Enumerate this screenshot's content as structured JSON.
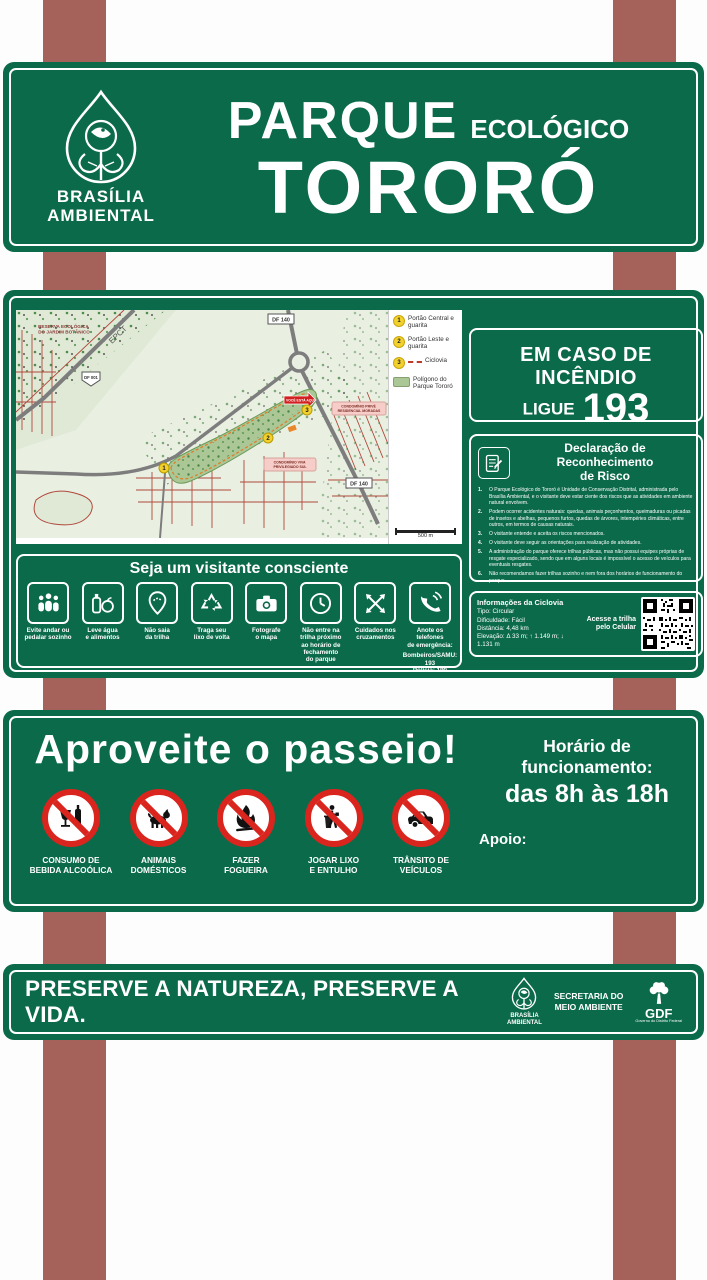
{
  "colors": {
    "panel_green": "#0b6a4a",
    "post_brown": "#a5625a",
    "prohibition_red": "#d9251d",
    "marker_yellow": "#f2d02e",
    "map_land": "#e9f0e2",
    "park_polygon": "#aac795",
    "street_red": "#b0483a"
  },
  "header": {
    "brand_line1": "BRASÍLIA",
    "brand_line2": "AMBIENTAL",
    "title_main": "PARQUE",
    "title_sub": "ECOLÓGICO",
    "park_name": "TORORÓ"
  },
  "map": {
    "labels": {
      "reserve_l1": "RESERVA ECOLÓGICA",
      "reserve_l2": "DO JARDIM BOTÂNICO",
      "epct": "EPCT",
      "shield": "DF 001",
      "df140_top": "DF 140",
      "df140_right": "DF 140",
      "condo_right_l1": "CONDOMÍNIO PRIVÊ",
      "condo_right_l2": "RESIDENCIAL MORADAS",
      "condo_mid_l1": "CONDOMÍNIO VIVA",
      "condo_mid_l2": "PRIVILEGIADO SUL",
      "you_are_here": "VOCÊ ESTÁ AQUI"
    },
    "markers": {
      "m1": "1",
      "m2": "2",
      "m3": "3"
    },
    "legend": {
      "item1": {
        "num": "1",
        "label": "Portão Central e guarita"
      },
      "item2": {
        "num": "2",
        "label": "Portão Leste e guarita"
      },
      "item3": {
        "num": "3",
        "label": "Ciclovia"
      },
      "item4": {
        "label": "Polígono do Parque Tororó"
      }
    },
    "scale": "500 m"
  },
  "emergency": {
    "line1": "EM CASO DE INCÊNDIO",
    "call_prefix": "LIGUE",
    "number": "193"
  },
  "declaration": {
    "title": "Declaração de Reconhecimento\nde Risco",
    "items": [
      {
        "n": "1.",
        "t": "O Parque Ecológico do Tororó é Unidade de Conservação Distrital, administrada pelo Brasília Ambiental, e o visitante deve estar ciente dos riscos que as atividades em ambiente natural envolvem."
      },
      {
        "n": "2.",
        "t": "Podem ocorrer acidentes naturais: quedas, animais peçonhentos, queimaduras ou picadas de insetos e abelhas, pequenos furtos, quedas de árvores, intempéries climáticas, entre outros, em termos de causas naturais."
      },
      {
        "n": "3.",
        "t": "O visitante entende e aceita os riscos mencionados."
      },
      {
        "n": "4.",
        "t": "O visitante deve seguir as orientações para realização de atividades."
      },
      {
        "n": "5.",
        "t": "A administração do parque oferece trilhas públicas, mas não possui equipes próprias de resgate especializado, sendo que em alguns locais é impossível o acesso de veículos para eventuais resgates."
      },
      {
        "n": "6.",
        "t": "Não recomendamos fazer trilhas sozinho e nem fora dos horários de funcionamento do parque."
      }
    ]
  },
  "visitor": {
    "title": "Seja um visitante consciente",
    "tips": [
      {
        "icon": "group-icon",
        "label": "Evite andar ou\npedalar sozinho"
      },
      {
        "icon": "water-food-icon",
        "label": "Leve água\ne alimentos"
      },
      {
        "icon": "stay-on-trail-icon",
        "label": "Não saia\nda trilha"
      },
      {
        "icon": "recycle-icon",
        "label": "Traga seu\nlixo de volta"
      },
      {
        "icon": "camera-icon",
        "label": "Fotografe\no mapa"
      },
      {
        "icon": "clock-icon",
        "label": "Não entre na\ntrilha próximo\nao horário de\nfechamento\ndo parque"
      },
      {
        "icon": "crossings-icon",
        "label": "Cuidados nos\ncruzamentos"
      },
      {
        "icon": "phone-icon",
        "label": "Anote os telefones\nde emergência:"
      }
    ],
    "emergency_line1": "Bombeiros/SAMU: 193",
    "emergency_line2": "Polícia: 190"
  },
  "ciclovia": {
    "title": "Informações da Ciclovia",
    "line_tipo": "Tipo: Circular",
    "line_dificuldade": "Dificuldade: Fácil",
    "line_distancia": "Distância: 4,48 km",
    "line_elevacao": "Elevação: Δ 33 m; ↑ 1.149 m; ↓ 1.131 m",
    "qr_caption": "Acesse a trilha\npelo Celular"
  },
  "enjoy": {
    "title": "Aproveite o passeio!",
    "hours_label": "Horário de funcionamento:",
    "hours_value": "das 8h às 18h",
    "support_label": "Apoio:",
    "prohibitions": [
      {
        "icon": "no-alcohol-icon",
        "label": "CONSUMO DE\nBEBIDA ALCOÓLICA"
      },
      {
        "icon": "no-pets-icon",
        "label": "ANIMAIS\nDOMÉSTICOS"
      },
      {
        "icon": "no-fire-icon",
        "label": "FAZER\nFOGUEIRA"
      },
      {
        "icon": "no-litter-icon",
        "label": "JOGAR LIXO\nE ENTULHO"
      },
      {
        "icon": "no-vehicles-icon",
        "label": "TRÂNSITO DE\nVEÍCULOS"
      }
    ]
  },
  "footer": {
    "message": "PRESERVE A NATUREZA, PRESERVE A VIDA.",
    "brand1": "BRASÍLIA\nAMBIENTAL",
    "brand2": "SECRETARIA DO\nMEIO AMBIENTE",
    "brand3": "GDF",
    "brand3_tagline": "Governo do Distrito Federal"
  }
}
